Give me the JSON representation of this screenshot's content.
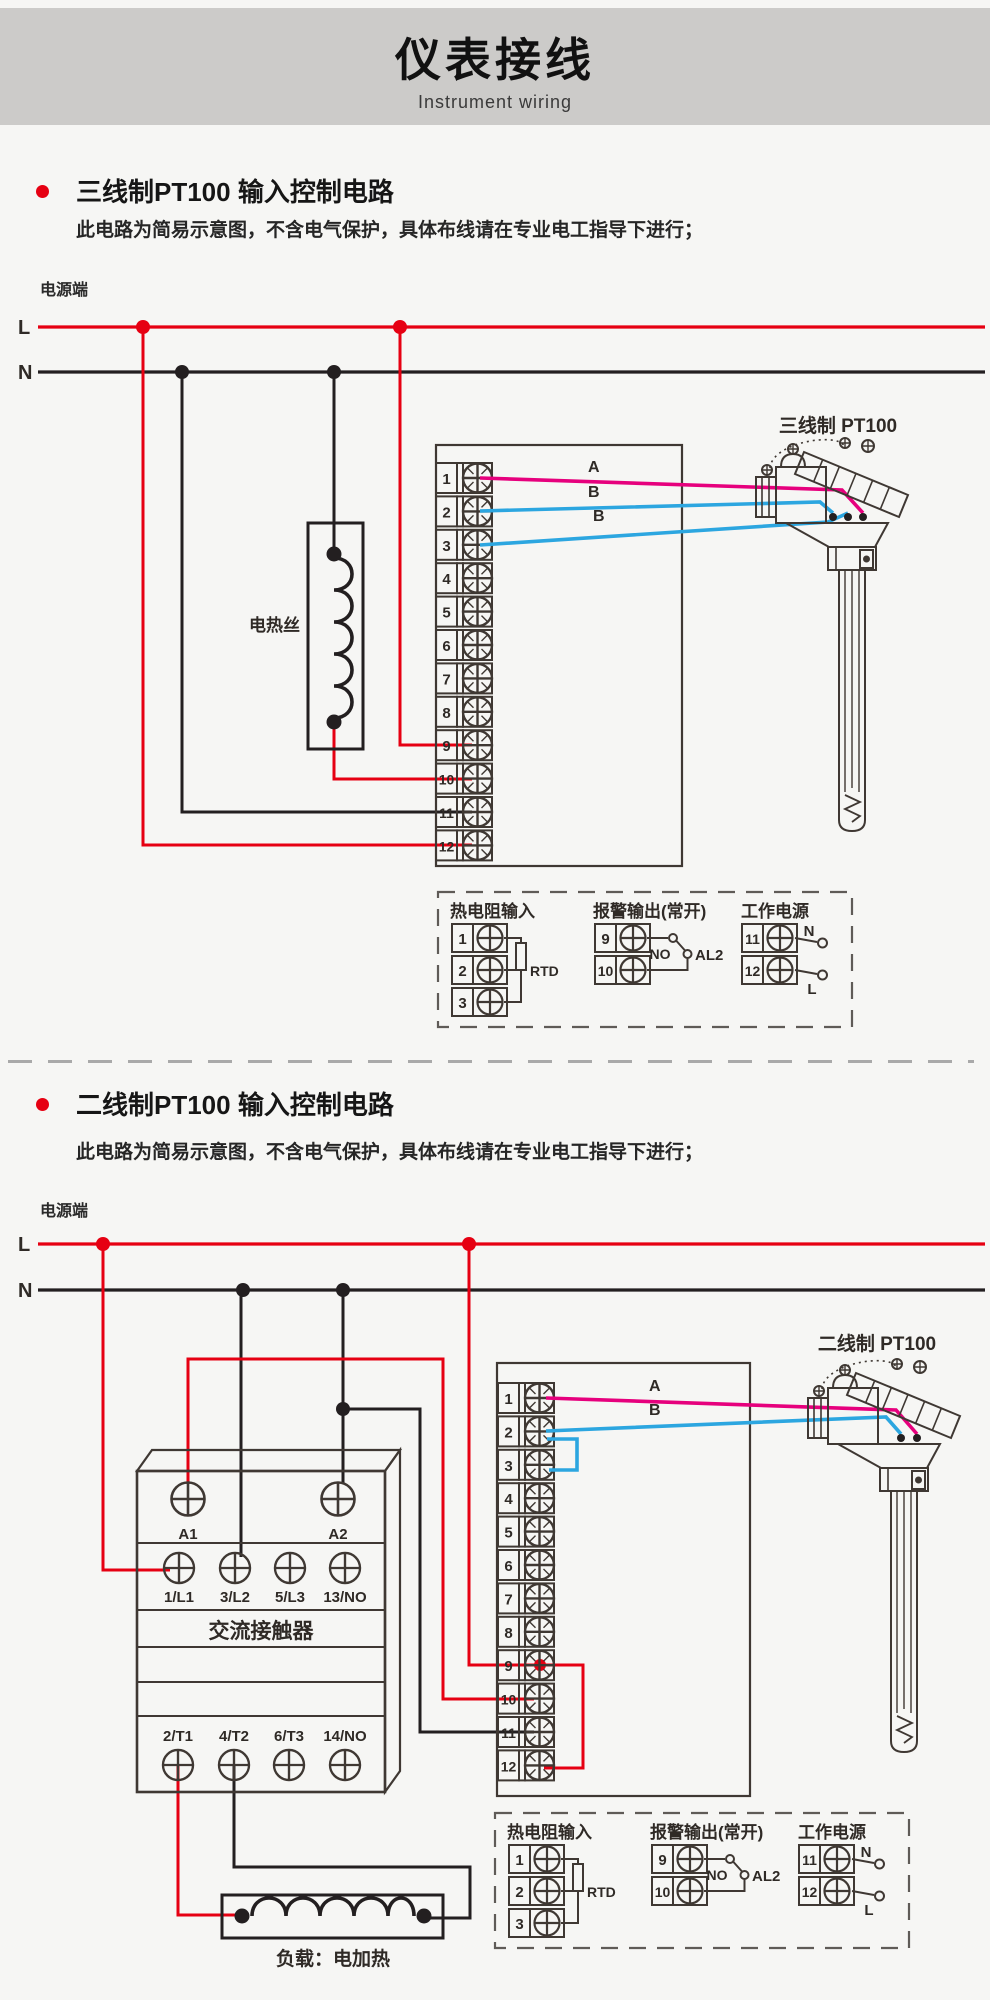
{
  "header": {
    "title": "仪表接线",
    "subtitle": "Instrument wiring"
  },
  "note": "此电路为简易示意图，不含电气保护，具体布线请在专业电工指导下进行；",
  "power_label": "电源端",
  "rails": {
    "l": "L",
    "n": "N"
  },
  "terminals": [
    "1",
    "2",
    "3",
    "4",
    "5",
    "6",
    "7",
    "8",
    "9",
    "10",
    "11",
    "12"
  ],
  "legend": {
    "rtd": {
      "title": "热电阻输入",
      "t1": "1",
      "t2": "2",
      "t3": "3",
      "component": "RTD"
    },
    "alarm": {
      "title": "报警输出(常开)",
      "t1": "9",
      "t2": "10",
      "no": "NO",
      "out": "AL2"
    },
    "power": {
      "title": "工作电源",
      "t1": "11",
      "t2": "12",
      "n": "N",
      "l": "L"
    }
  },
  "section1": {
    "heading": "三线制PT100 输入控制电路",
    "heater_label": "电热丝",
    "sensor_label": "三线制 PT100",
    "wire_a": "A",
    "wire_b1": "B",
    "wire_b2": "B"
  },
  "section2": {
    "heading": "二线制PT100 输入控制电路",
    "sensor_label": "二线制 PT100",
    "load_label": "负载：电加热",
    "wire_a": "A",
    "wire_b": "B",
    "contactor": {
      "name": "交流接触器",
      "a1": "A1",
      "a2": "A2",
      "r1c1": "1/L1",
      "r1c2": "3/L2",
      "r1c3": "5/L3",
      "r1c4": "13/NO",
      "r2c1": "2/T1",
      "r2c2": "4/T2",
      "r2c3": "6/T3",
      "r2c4": "14/NO"
    }
  },
  "colors": {
    "accent_red": "#e60012",
    "wire_black": "#231f20",
    "wire_magenta": "#e6007d",
    "wire_blue": "#2ca6e0"
  }
}
